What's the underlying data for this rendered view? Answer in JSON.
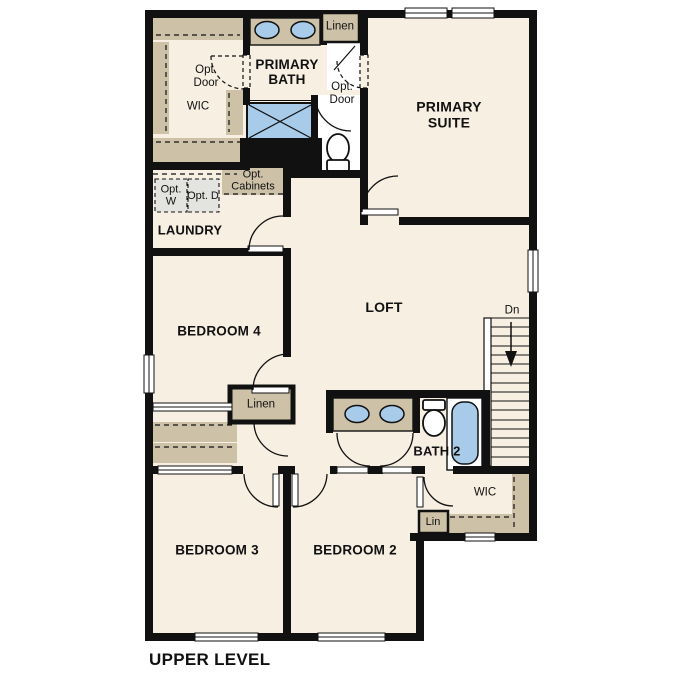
{
  "title": "UPPER LEVEL",
  "colors": {
    "floor": "#f6efe2",
    "wall": "#111111",
    "cabinet_tan": "#cdc1a8",
    "fixture_blue": "#a9cbea",
    "appliance_gray": "#e3e3df"
  },
  "rooms": {
    "primary_bath": "PRIMARY BATH",
    "primary_suite": "PRIMARY SUITE",
    "laundry": "LAUNDRY",
    "bedroom4": "BEDROOM 4",
    "loft": "LOFT",
    "bath2": "BATH 2",
    "bedroom3": "BEDROOM 3",
    "bedroom2": "BEDROOM 2"
  },
  "labels": {
    "wic_upper": "WIC",
    "opt_door_left": "Opt. Door",
    "linen_upper": "Linen",
    "opt_door_right": "Opt. Door",
    "opt_washer": "Opt. W",
    "opt_dryer": "Opt. D",
    "opt_cabinets": "Opt. Cabinets",
    "linen_hall": "Linen",
    "stairs_down": "Dn",
    "wic_lower": "WIC",
    "linen_lower": "Lin",
    "bath2_line1": "BATH 2"
  }
}
